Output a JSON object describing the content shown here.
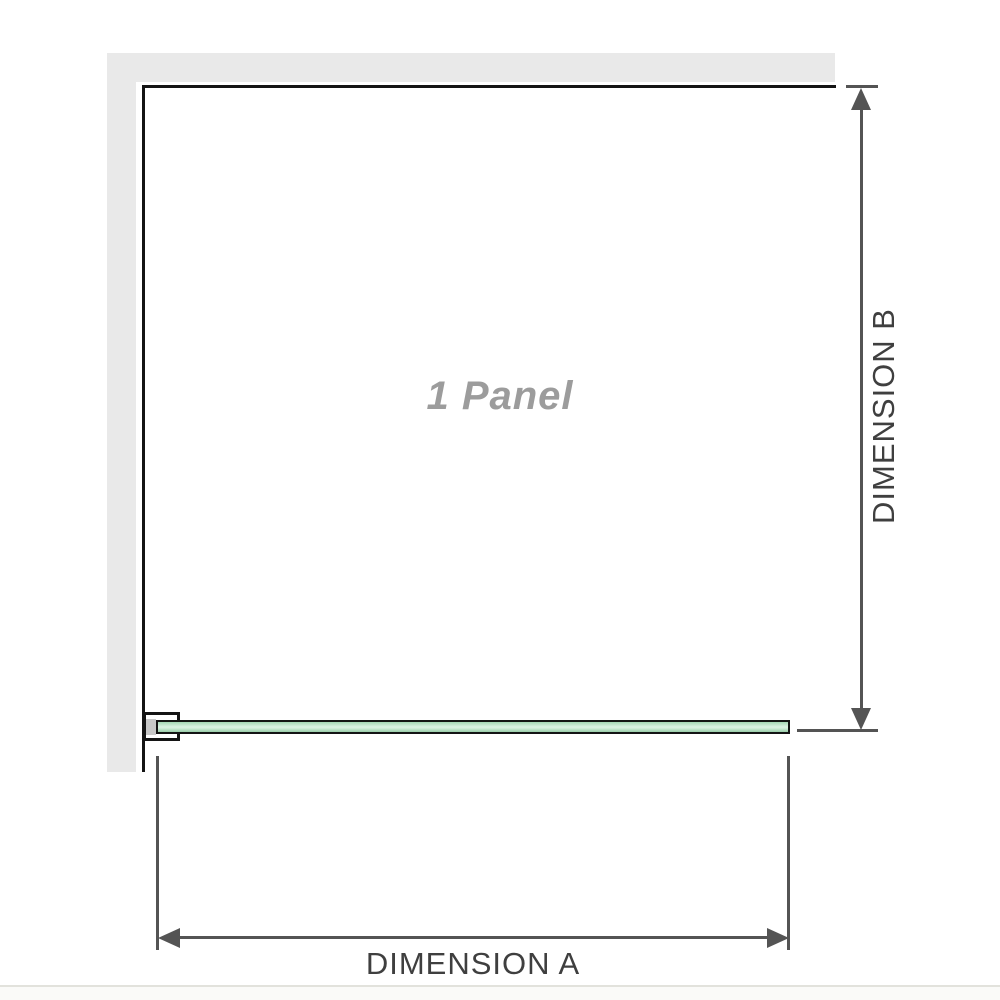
{
  "diagram": {
    "panel_label": "1 Panel",
    "dimension_a_label": "DIMENSION A",
    "dimension_b_label": "DIMENSION B"
  },
  "colors": {
    "wall": "#e9e9e9",
    "outline": "#141414",
    "dimension": "#545454",
    "label": "#3f3f3f",
    "panel-label": "#9c9c9c",
    "glass-green": "#a5d6b4",
    "glass-highlight": "#d8f0e0",
    "divider": "#e2e2dc"
  }
}
